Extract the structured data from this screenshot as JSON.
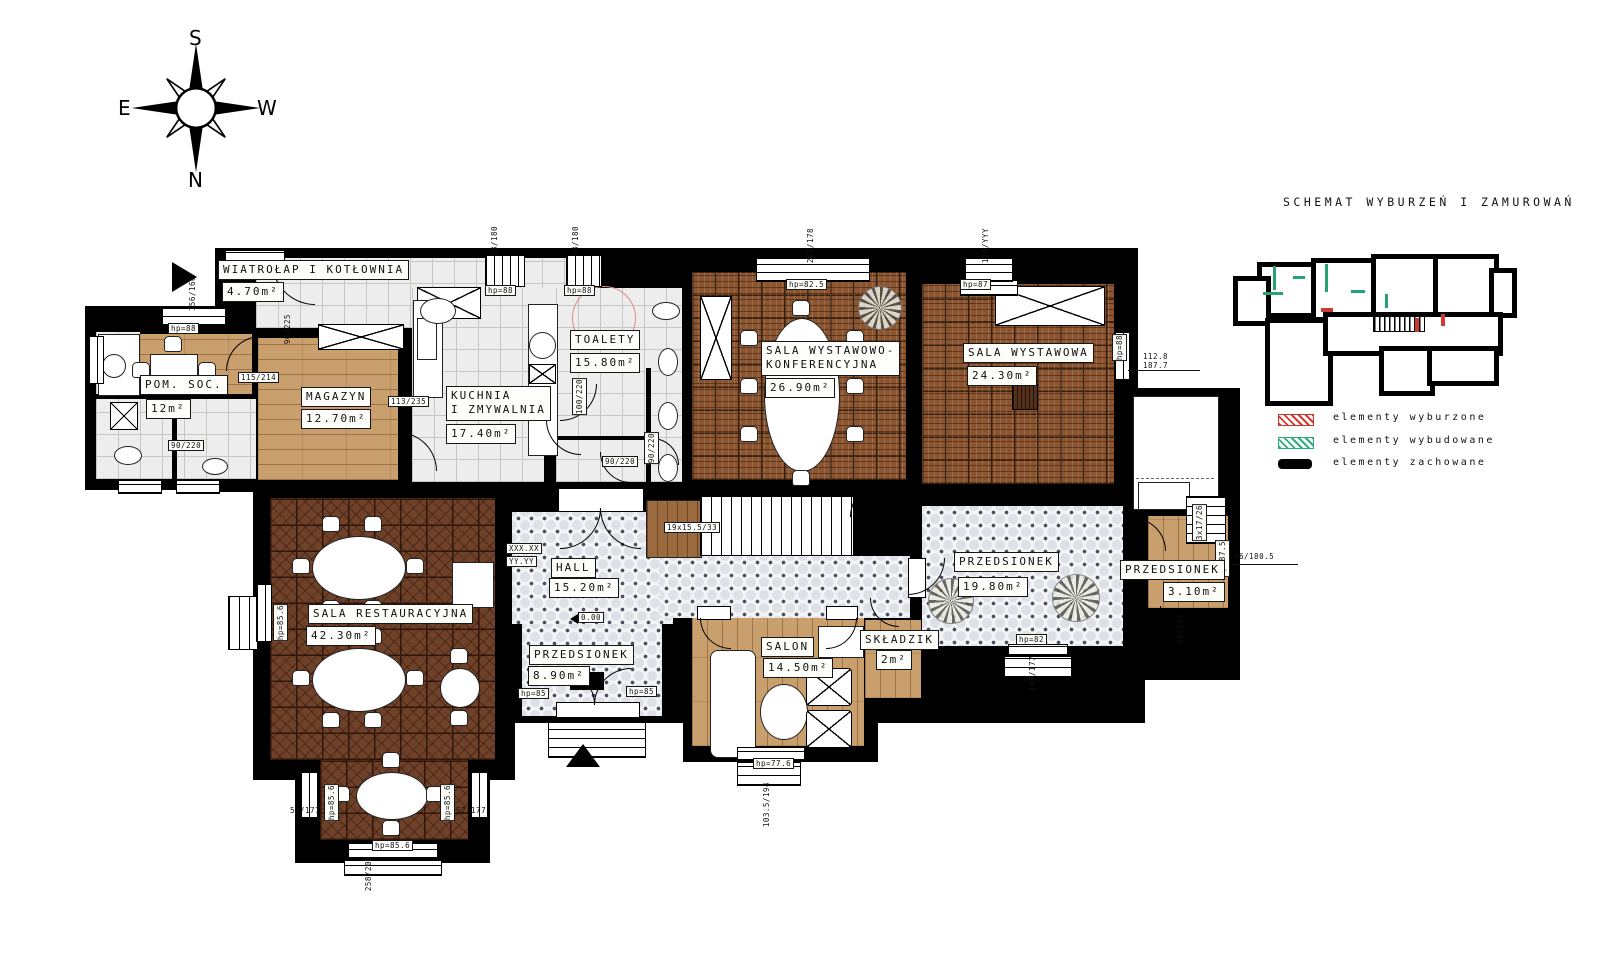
{
  "compass": {
    "top": "S",
    "bottom": "N",
    "left": "E",
    "right": "W"
  },
  "schematic": {
    "title": "SCHEMAT WYBURZEŃ I ZAMUROWAŃ",
    "legend": [
      {
        "label": "elementy wyburzone",
        "swatch": "red-hatch",
        "color": "#d43a2e"
      },
      {
        "label": "elementy wybudowane",
        "swatch": "green-hatch",
        "color": "#2fae7d"
      },
      {
        "label": "elementy zachowane",
        "swatch": "black-solid",
        "color": "#000000"
      }
    ]
  },
  "rooms": [
    {
      "lines": [
        "WIATROŁAP I KOTŁOWNIA"
      ],
      "area": "4.70m²",
      "floor": "tile-grey"
    },
    {
      "lines": [
        "POM. SOC."
      ],
      "area": "12m²",
      "floor": "wood"
    },
    {
      "lines": [
        "MAGAZYN"
      ],
      "area": "12.70m²",
      "floor": "wood"
    },
    {
      "lines": [
        "KUCHNIA",
        "I ZMYWALNIA"
      ],
      "area": "17.40m²",
      "floor": "tile-grey"
    },
    {
      "lines": [
        "TOALETY"
      ],
      "area": "15.80m²",
      "floor": "tile-grey"
    },
    {
      "lines": [
        "SALA WYSTAWOWO-",
        "KONFERENCYJNA"
      ],
      "area": "26.90m²",
      "floor": "parquet-basket"
    },
    {
      "lines": [
        "SALA WYSTAWOWA"
      ],
      "area": "24.30m²",
      "floor": "parquet-basket"
    },
    {
      "lines": [
        "SALA RESTAURACYJNA"
      ],
      "area": "42.30m²",
      "floor": "parquet-dark"
    },
    {
      "lines": [
        "HALL"
      ],
      "area": "15.20m²",
      "floor": "octagon-tile"
    },
    {
      "lines": [
        "PRZEDSIONEK"
      ],
      "area": "8.90m²",
      "floor": "octagon-tile"
    },
    {
      "lines": [
        "SALON"
      ],
      "area": "14.50m²",
      "floor": "wood"
    },
    {
      "lines": [
        "SKŁADZIK"
      ],
      "area": "2m²",
      "floor": "wood"
    },
    {
      "lines": [
        "PRZEDSIONEK"
      ],
      "area": "19.80m²",
      "floor": "octagon-tile"
    },
    {
      "lines": [
        "PRZEDSIONEK"
      ],
      "area": "3.10m²",
      "floor": "wood"
    }
  ],
  "ann": {
    "hp88_a": "hp=88",
    "hp88_b": "hp=88",
    "hp88_c": "hp=88",
    "hp88_d": "hp=88",
    "hp825": "hp=82.5",
    "hp87": "hp=87",
    "hp856_a": "hp=85.6",
    "hp856_b": "hp=85.6",
    "hp856_c": "hp=85.6",
    "hp856_d": "hp=85.6",
    "hp85_a": "hp=85",
    "hp85_b": "hp=85",
    "hp776": "hp=77.6",
    "hp82": "hp=82",
    "hp875": "hp=87.5",
    "d98a": "98/180",
    "d98b": "98/180",
    "d263": "263/178",
    "d110": "110/YYY",
    "d156": "156/166",
    "d112": "112.8",
    "d187": "187.7",
    "d52a": "52/177",
    "d52b": "52/177",
    "d258": "258/208",
    "d1035": "103.5/194",
    "d106": "106/177",
    "d46": "46/180.5",
    "door_a": "90/225",
    "door_b": "115/214",
    "door_c": "113/235",
    "door_d": "90/220",
    "door_e": "100/220",
    "door_f": "90/220",
    "door_g": "90/220",
    "door_h": "80/202",
    "stair_main": "19x15.5/33",
    "stair_side": "3x17/26",
    "level": "0.00",
    "ph_a": "XXX.XX",
    "ph_b": "YY.YY"
  }
}
